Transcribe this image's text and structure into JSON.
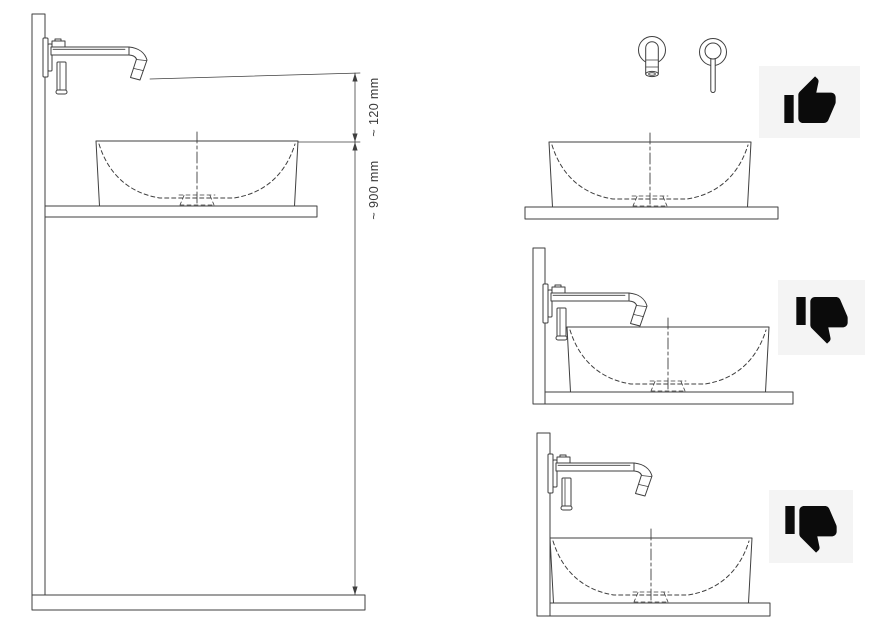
{
  "page": {
    "background": "#ffffff",
    "description": "faucet and vessel basin installation height diagram"
  },
  "colors": {
    "line": "#3f3f3f",
    "text": "#3a3a3a",
    "icon_box_bg": "#f4f4f4",
    "icon_color": "#0b0b0b"
  },
  "main_diagram": {
    "dim_spout_to_rim_label": "~ 120 mm",
    "dim_rim_to_floor_label": "~ 900 mm"
  },
  "panels": {
    "correct_front_view": {
      "icon": "thumbs-up-icon"
    },
    "faucet_too_low": {
      "icon": "thumbs-down-icon"
    },
    "basin_against_wall": {
      "icon": "thumbs-down-icon"
    }
  }
}
